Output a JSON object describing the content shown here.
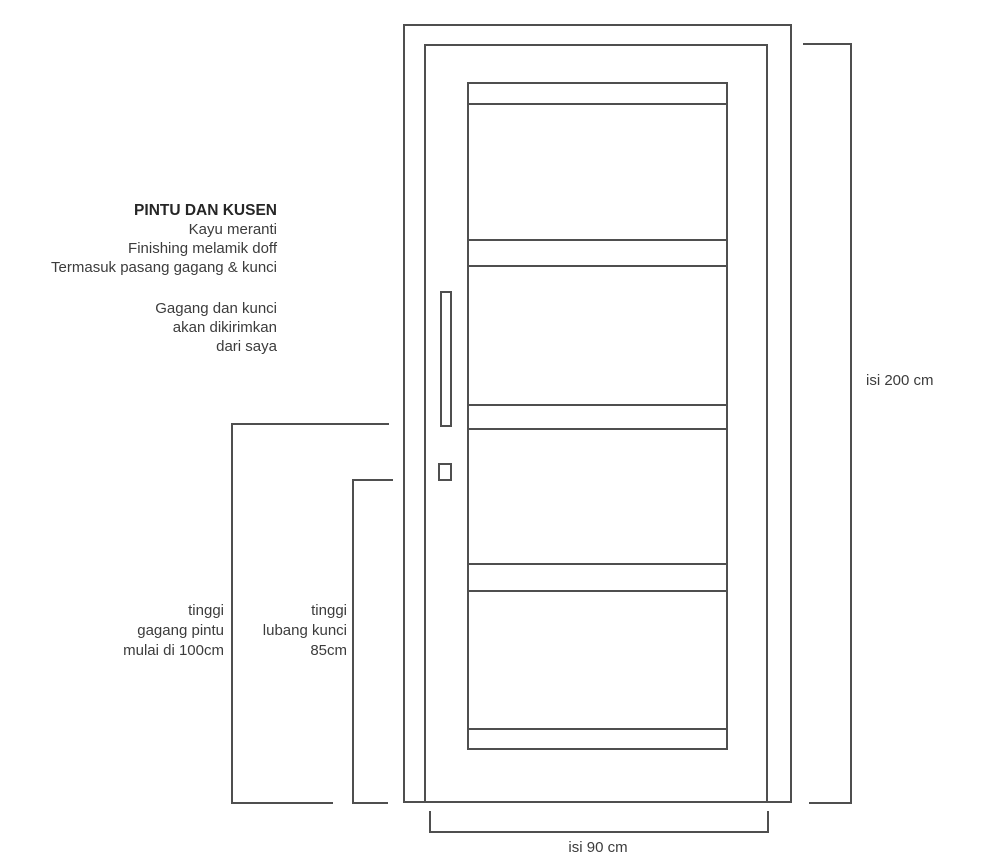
{
  "spec": {
    "title": "PINTU DAN KUSEN",
    "material": "Kayu meranti",
    "finishing": "Finishing melamik doff",
    "includes": "Termasuk pasang gagang & kunci",
    "note_line1": "Gagang dan kunci",
    "note_line2": "akan dikirimkan",
    "note_line3": "dari saya"
  },
  "dimensions": {
    "door_height": "isi 200 cm",
    "door_width": "isi 90 cm",
    "handle": {
      "line1": "tinggi",
      "line2": "gagang pintu",
      "line3": "mulai di 100cm"
    },
    "keyhole": {
      "line1": "tinggi",
      "line2": "lubang kunci",
      "line3": "85cm"
    }
  },
  "colors": {
    "line": "#4f4f4f",
    "text": "#3c3c3c",
    "background": "#ffffff"
  }
}
